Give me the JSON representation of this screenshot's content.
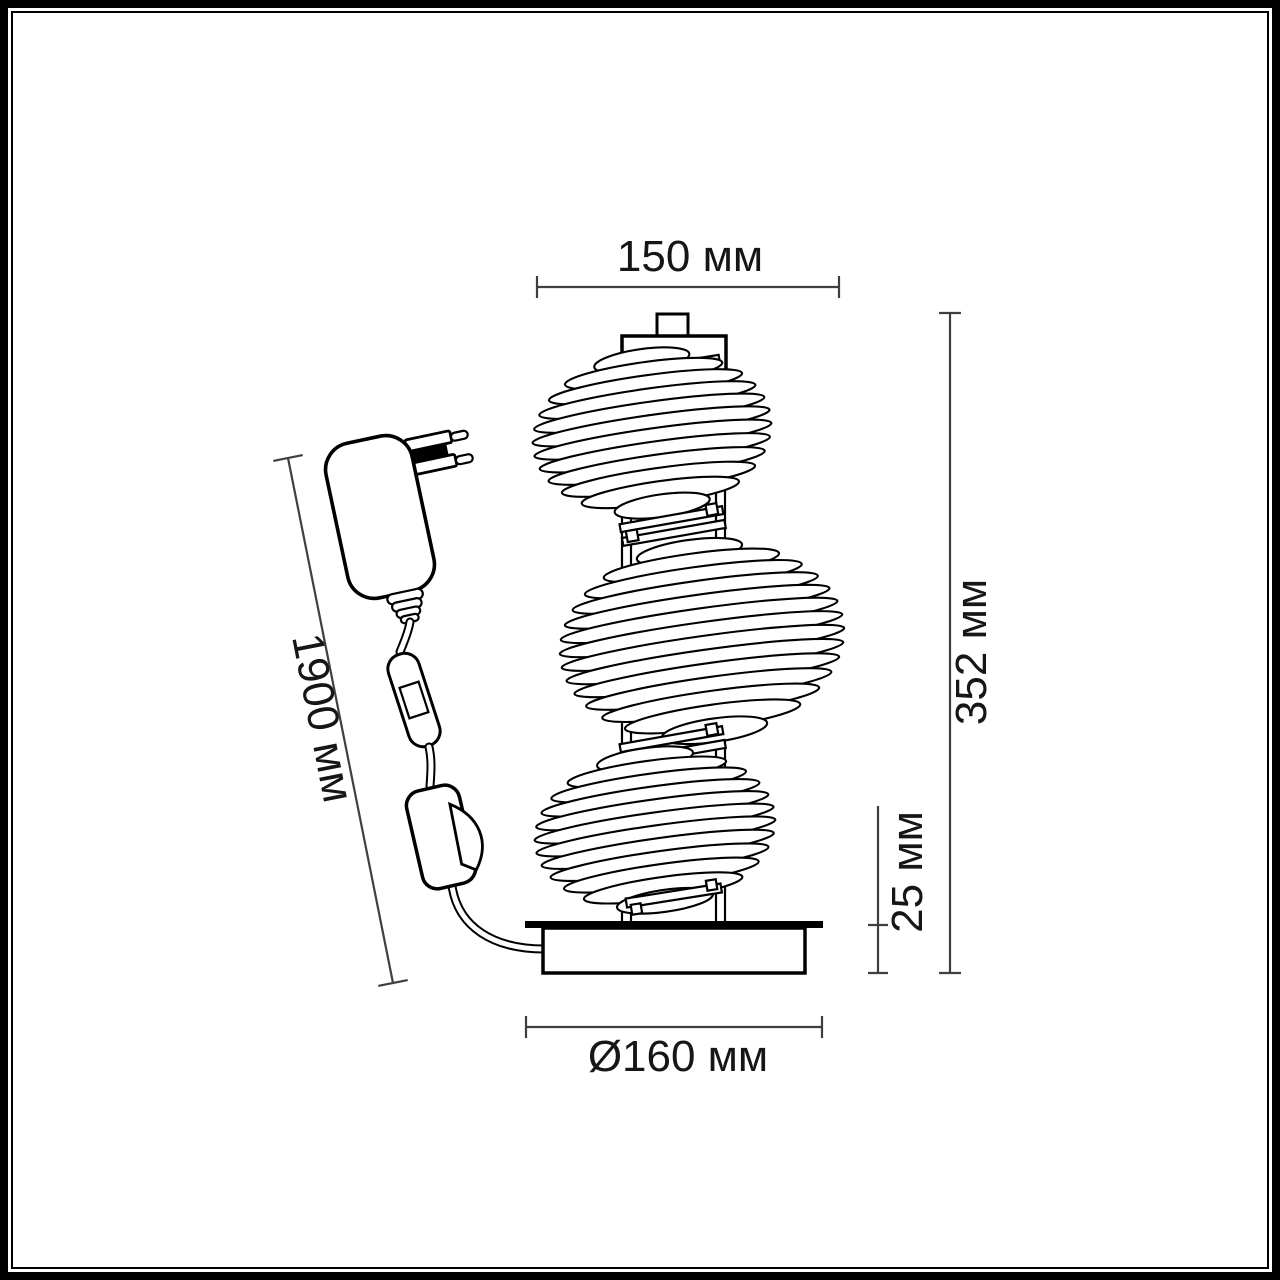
{
  "dimension_labels": {
    "top_width": "150 мм",
    "total_height": "352 мм",
    "base_height": "25 мм",
    "base_diameter": "Ø160 мм",
    "cord_length": "1900 мм"
  },
  "colors": {
    "background": "#ffffff",
    "line_art": "#000000",
    "dimension_lines": "#3f3f3f",
    "label_text": "#161616"
  }
}
